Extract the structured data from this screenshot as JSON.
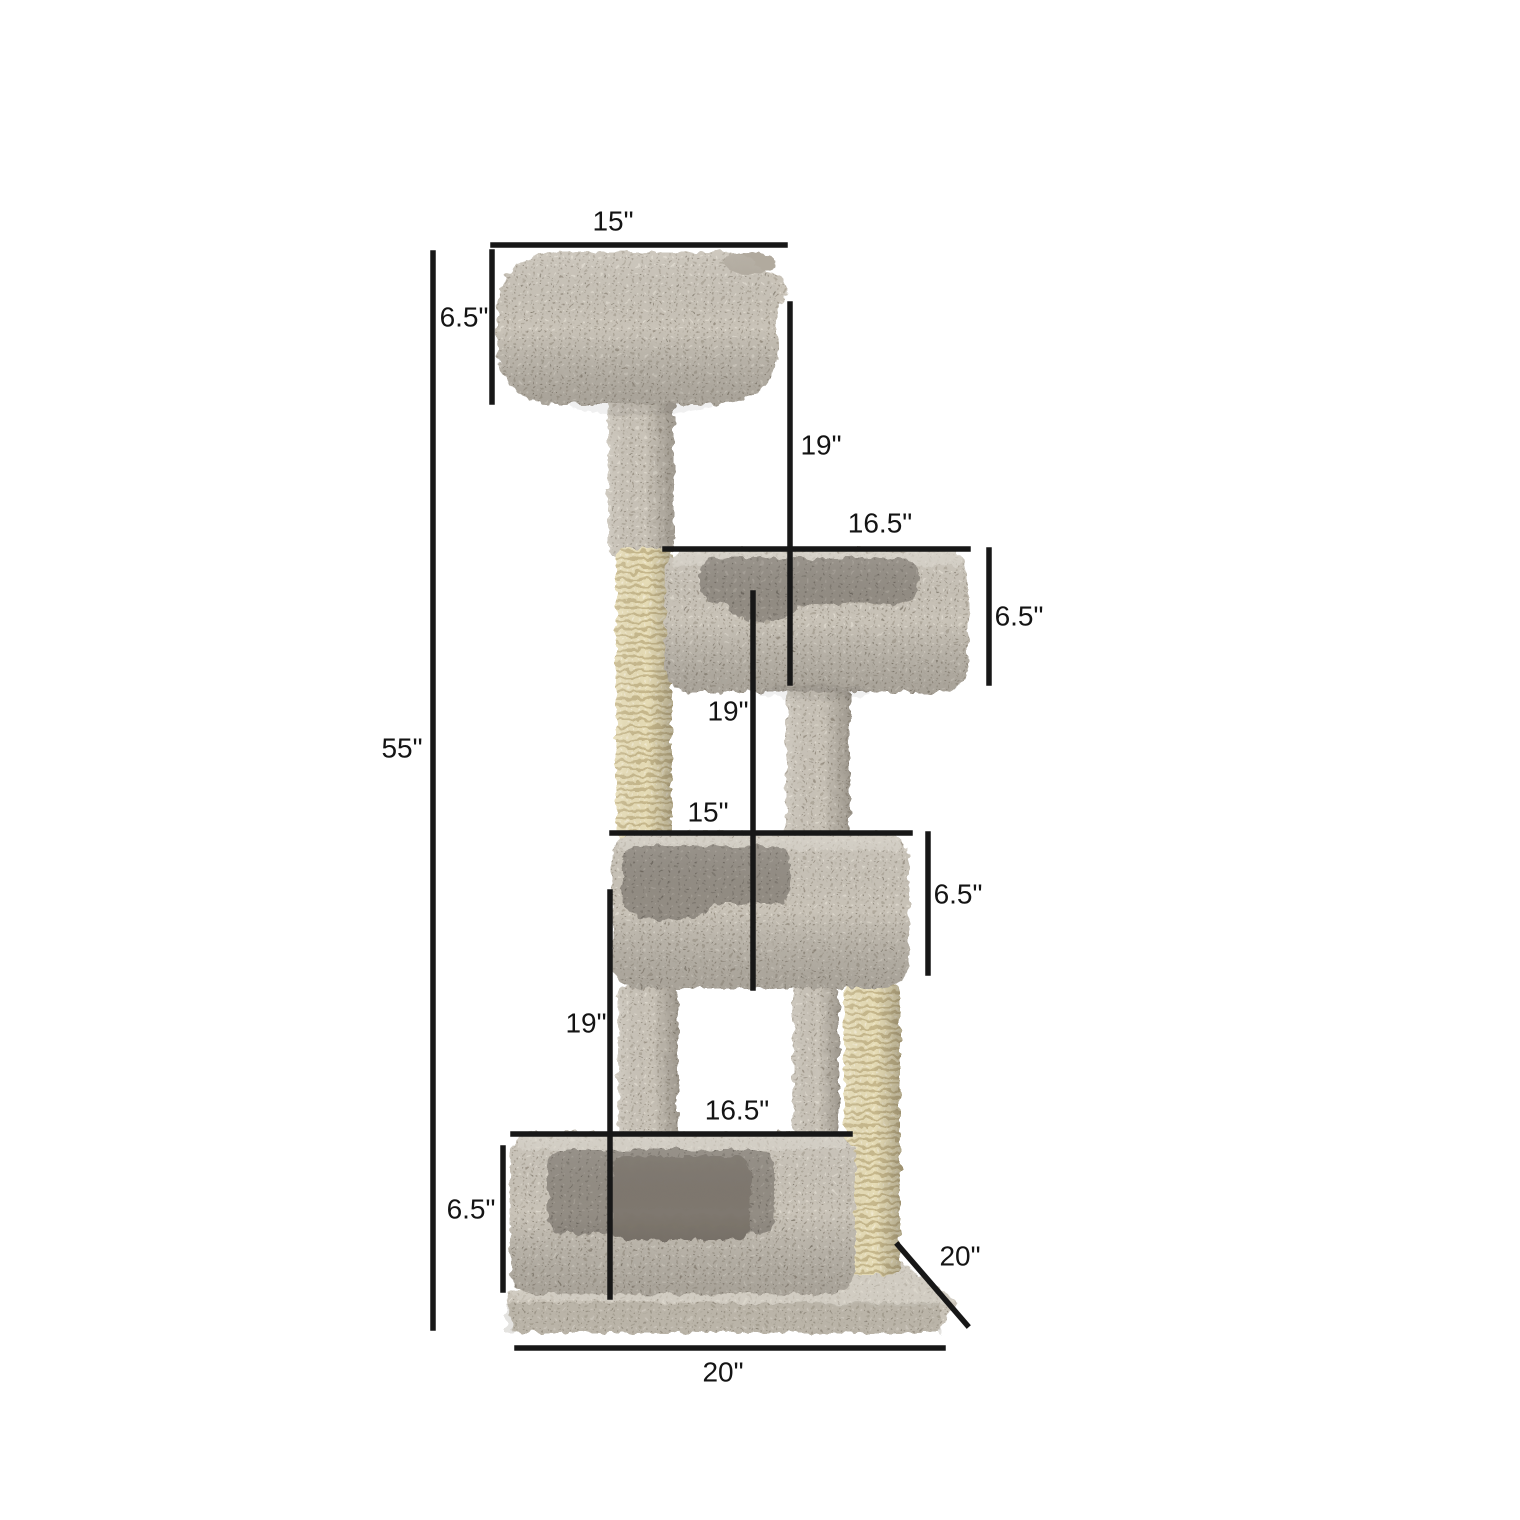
{
  "image": {
    "background": "#ffffff",
    "subject": "cat-tree-dimension-diagram"
  },
  "colors": {
    "carpet": "#cac4ba",
    "carpet_interior": "#938d84",
    "sisal_rope": "#e6dcb6",
    "dimension_line": "#171717",
    "label_text": "#141414"
  },
  "dimensions": {
    "total_height": {
      "label": "55\""
    },
    "top_bed_width": {
      "label": "15\""
    },
    "top_bed_depth": {
      "label": "6.5\""
    },
    "upper_post_drop": {
      "label": "19\""
    },
    "second_bed_width": {
      "label": "16.5\""
    },
    "second_bed_depth": {
      "label": "6.5\""
    },
    "middle_post_drop": {
      "label": "19\""
    },
    "third_bed_width": {
      "label": "15\""
    },
    "third_bed_depth": {
      "label": "6.5\""
    },
    "lower_post_drop": {
      "label": "19\""
    },
    "bottom_bed_width": {
      "label": "16.5\""
    },
    "bottom_bed_depth": {
      "label": "6.5\""
    },
    "base_depth": {
      "label": "20\""
    },
    "base_width": {
      "label": "20\""
    }
  }
}
